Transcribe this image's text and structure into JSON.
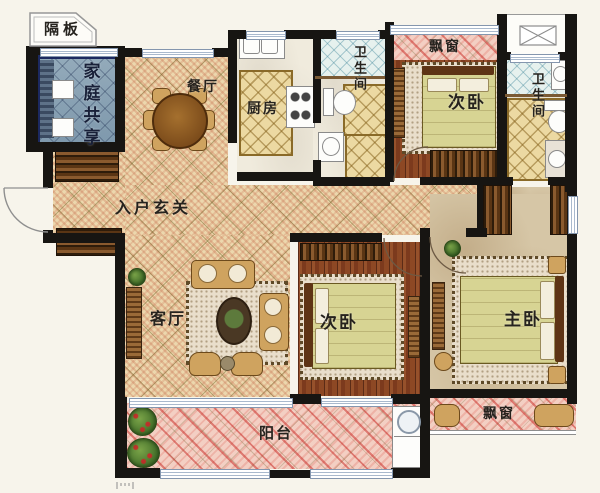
{
  "rooms": {
    "partition": {
      "label": "隔板"
    },
    "family": {
      "label": "家庭共享"
    },
    "dining": {
      "label": "餐厅"
    },
    "kitchen": {
      "label": "厨房"
    },
    "bath1": {
      "label": "卫生间"
    },
    "bay_top": {
      "label": "飘窗"
    },
    "bedroom_top": {
      "label": "次卧"
    },
    "bath2": {
      "label": "卫生间"
    },
    "foyer": {
      "label": "入户玄关"
    },
    "living": {
      "label": "客厅"
    },
    "bedroom_mid": {
      "label": "次卧"
    },
    "master": {
      "label": "主卧"
    },
    "bay_bottom": {
      "label": "飘窗"
    },
    "balcony": {
      "label": "阳台"
    }
  },
  "colors": {
    "wall": "#171512",
    "floor_tan": "#ecd7ad",
    "floor_wood": "#8a4522",
    "floor_pink": "#f3cfc3",
    "family_room_blue": "#8ba3b5",
    "family_room_border": "#1c2960",
    "floor_beige": "#d6c6a6",
    "bath_diamond_gold": "#ecd9a2",
    "bath_diamond_blue": "#e6f1ee",
    "stripe_red": "#c23b2e"
  }
}
